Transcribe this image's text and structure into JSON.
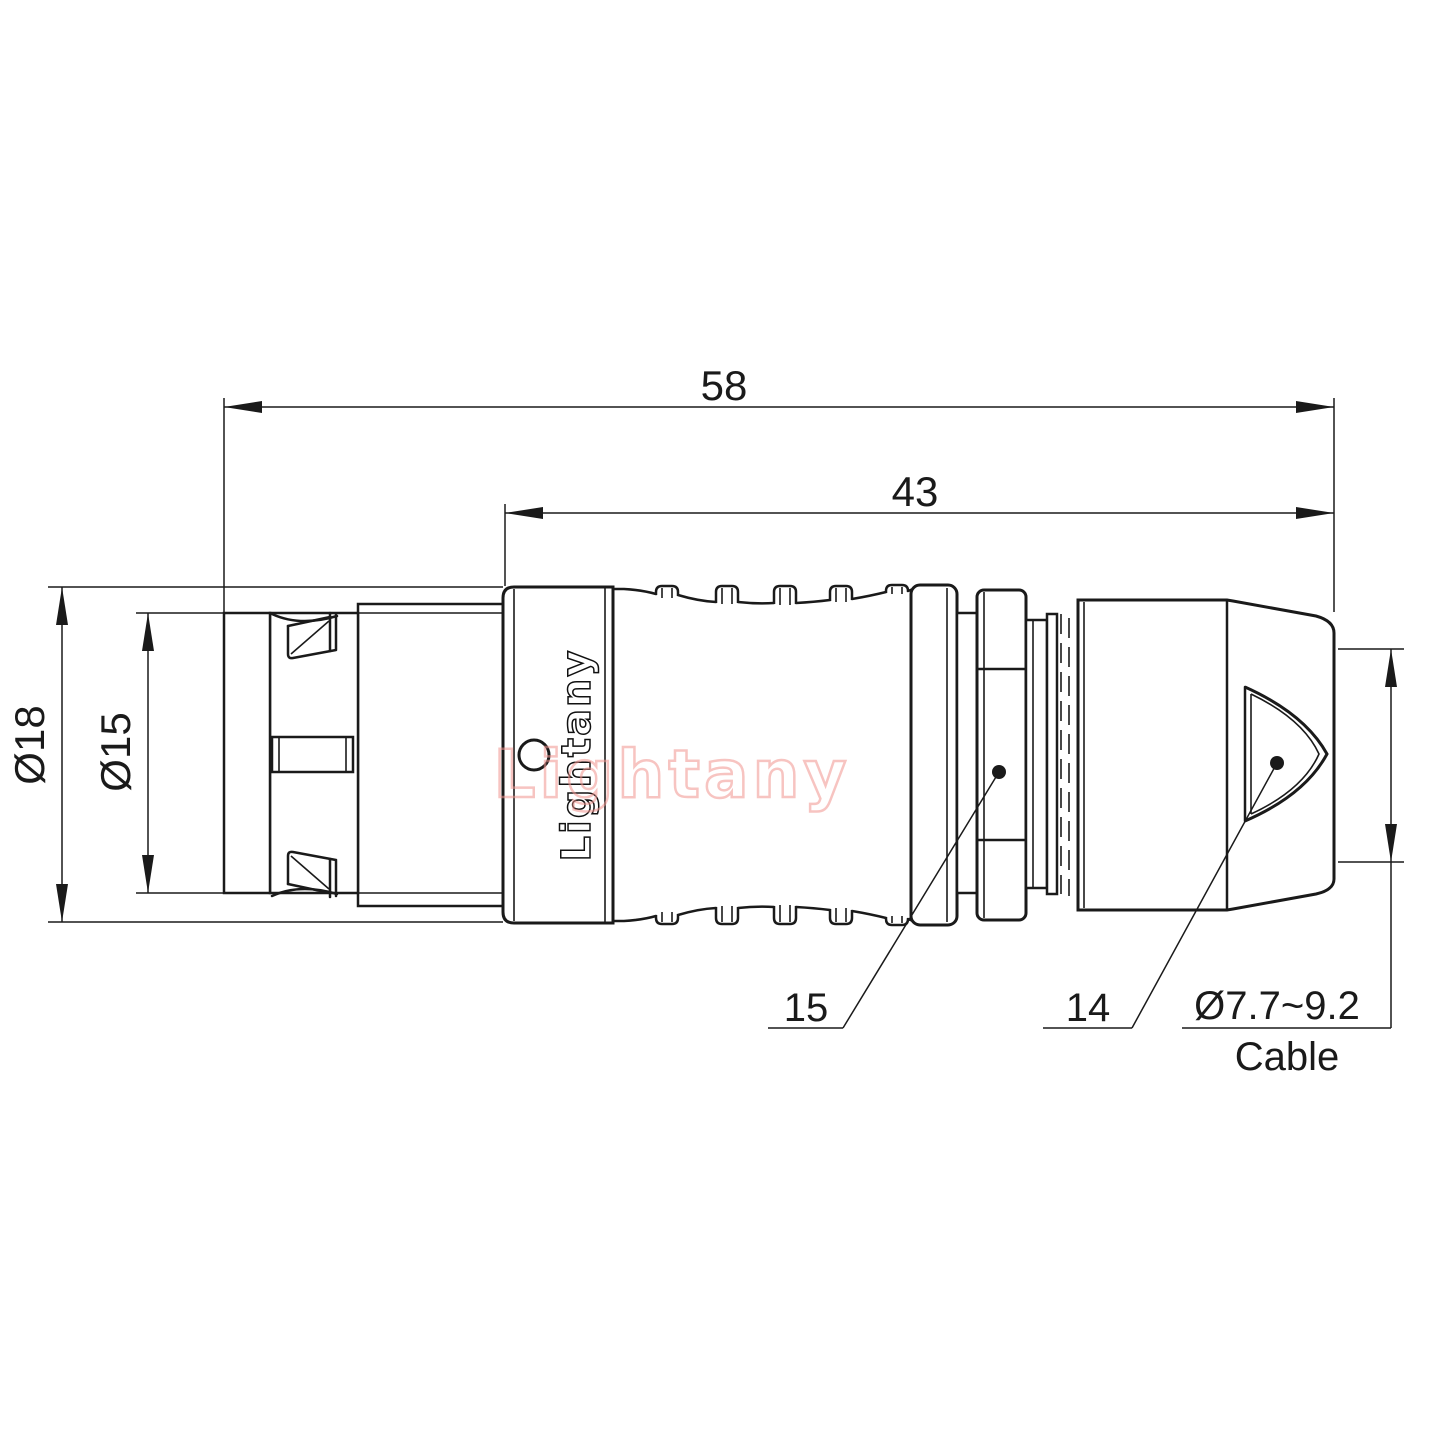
{
  "drawing": {
    "brand_logo": "Lightany",
    "watermark": "Lightany",
    "colors": {
      "line": "#1a1a1a",
      "watermark_pink": "#f2948f"
    },
    "dimensions": {
      "overall_length": "58",
      "rear_length": "43",
      "outer_diameter": "Ø18",
      "sleeve_diameter": "Ø15",
      "nut_item_label": "15",
      "backshell_item_label": "14",
      "cable_range": "Ø7.7~9.2",
      "cable_word": "Cable"
    }
  }
}
